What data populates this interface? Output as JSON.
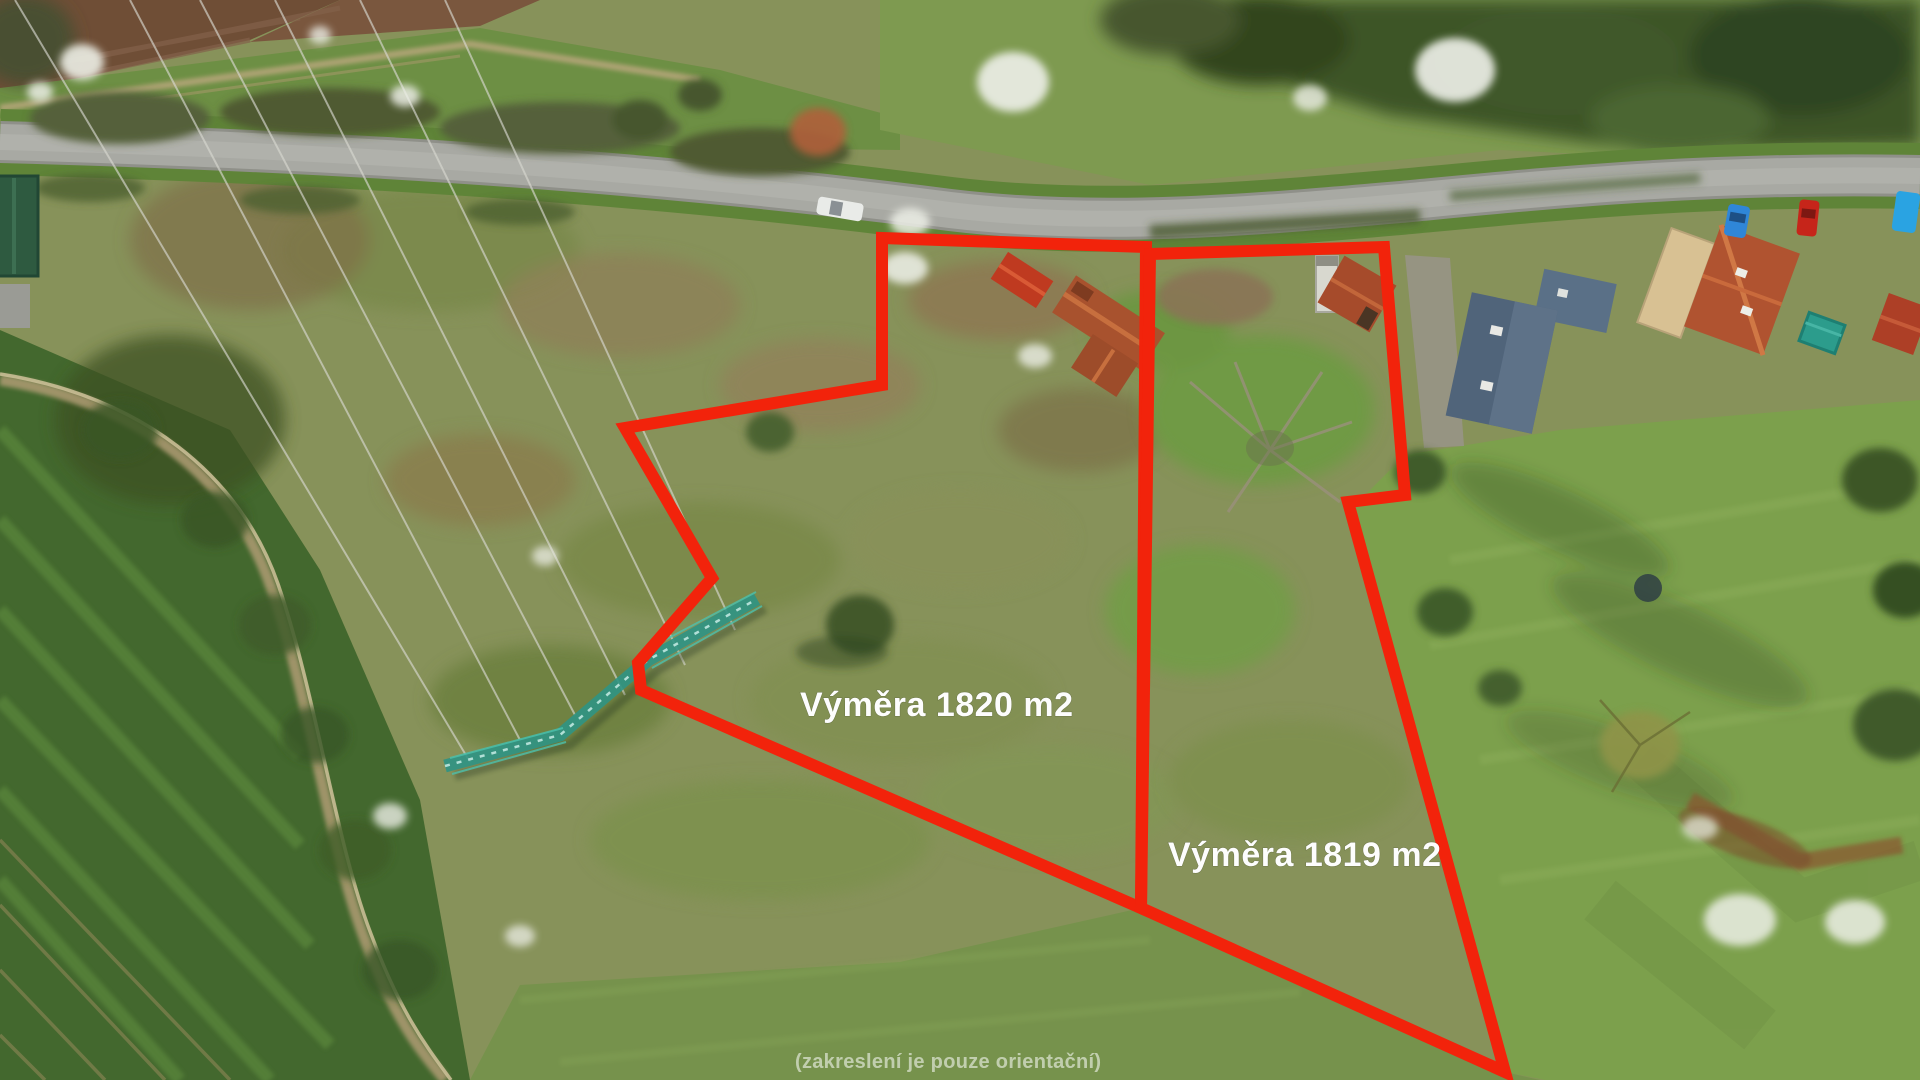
{
  "image": {
    "kind": "aerial-drone-photo-with-parcel-overlay",
    "width": 1920,
    "height": 1080
  },
  "overlay": {
    "accent_color": "#f2230b",
    "stroke_width": 12,
    "label_color": "#fdfdfd",
    "parcels": [
      {
        "id": "parcel-1820",
        "label": "Výměra 1820 m2",
        "area_m2": 1820,
        "label_x": 800,
        "label_y": 716,
        "points": "882,238 1146,247 1141,908 641,690 638,663 712,578 625,428 882,385"
      },
      {
        "id": "parcel-1819",
        "label": "Výměra 1819 m2",
        "area_m2": 1819,
        "label_x": 1168,
        "label_y": 866,
        "points": "1150,254 1384,247 1405,495 1348,502 1505,1072 1141,908"
      }
    ],
    "disclaimer": {
      "text": "(zakreslení je pouze orientační)",
      "x": 795,
      "y": 1068
    }
  },
  "scene_palette": {
    "scrub_base": "#87925a",
    "road": "#a8a9a3",
    "crop_field": "#43682e",
    "meadow": "#7ca04c",
    "tree_dark": "#3b5226",
    "soil_brown": "#6f4e36",
    "pylon_teal": "#2f9484",
    "roof_orange": "#a8522e",
    "roof_slate": "#50647a",
    "roof_red": "#bf3a20",
    "blossom_white": "#eceee6"
  }
}
